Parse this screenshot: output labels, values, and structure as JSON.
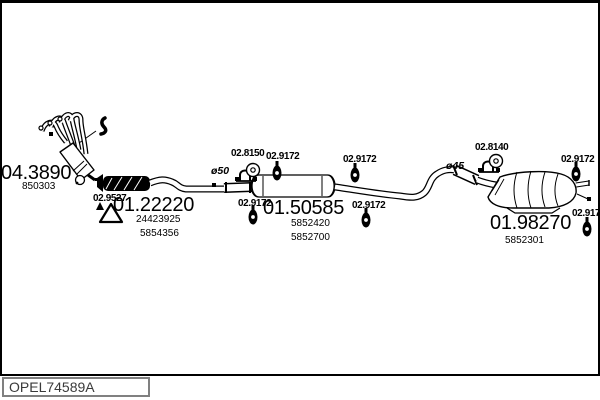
{
  "diagram_code": "OPEL74589A",
  "colors": {
    "ink": "#000000",
    "background": "#ffffff"
  },
  "parts": {
    "manifold_catalyst": {
      "part_no": "04.3890",
      "refs": [
        "850303"
      ]
    },
    "gasket": {
      "part_no": "02.9527"
    },
    "front_pipe": {
      "part_no": "01.22220",
      "refs": [
        "24423925",
        "5854356"
      ]
    },
    "centre_silencer": {
      "part_no": "01.50585",
      "refs": [
        "5852420",
        "5852700"
      ]
    },
    "rear_silencer": {
      "part_no": "01.98270",
      "refs": [
        "5852301"
      ]
    },
    "clamp_front": {
      "part_no": "02.8150"
    },
    "clamp_rear": {
      "part_no": "02.8140"
    },
    "rubber_mounting": {
      "part_no": "02.9172"
    },
    "dia_front": "ø50",
    "dia_rear": "ø45"
  }
}
